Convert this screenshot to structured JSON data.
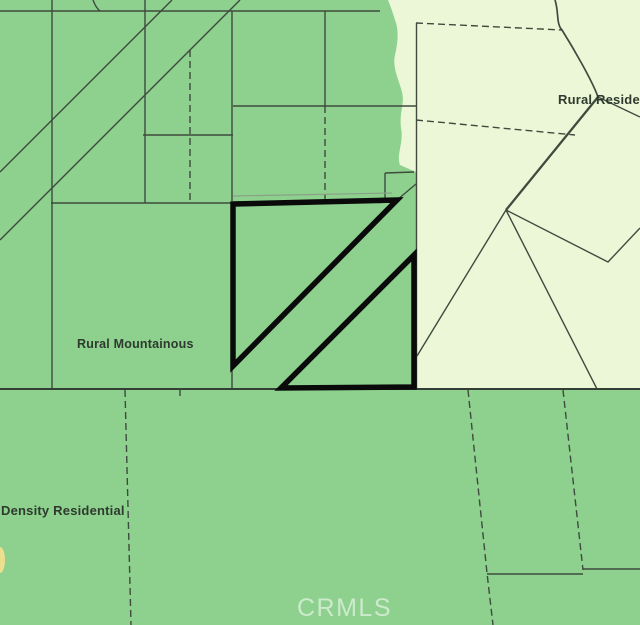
{
  "map": {
    "labels": {
      "rural_mountainous": "Rural Mountainous",
      "rural_residential": "Rural Residen",
      "density_residential": "Density Residential"
    },
    "watermark": "CRMLS",
    "zones": [
      {
        "name": "Rural Mountainous",
        "color_key": "zone_green"
      },
      {
        "name": "Rural Residential",
        "color_key": "zone_light"
      },
      {
        "name": "Density Residential",
        "color_key": "zone_green"
      }
    ],
    "highlighted_parcel": {
      "description": "subject property outlined in black, two triangular lots",
      "outline_color": "#0a0a0a"
    }
  },
  "colors": {
    "zone_green": "#8ed08e",
    "zone_light": "#ecf7d7",
    "parcel_line": "#3e4b3e",
    "parcel_line_light": "#8aa08a",
    "boundary_line": "#343f36",
    "highlight_outline": "#0a0a0a",
    "label_text": "#2e3a2e",
    "watermark_text": "rgba(255,255,255,0.55)",
    "poi_yellow": "#ecdf8d"
  }
}
